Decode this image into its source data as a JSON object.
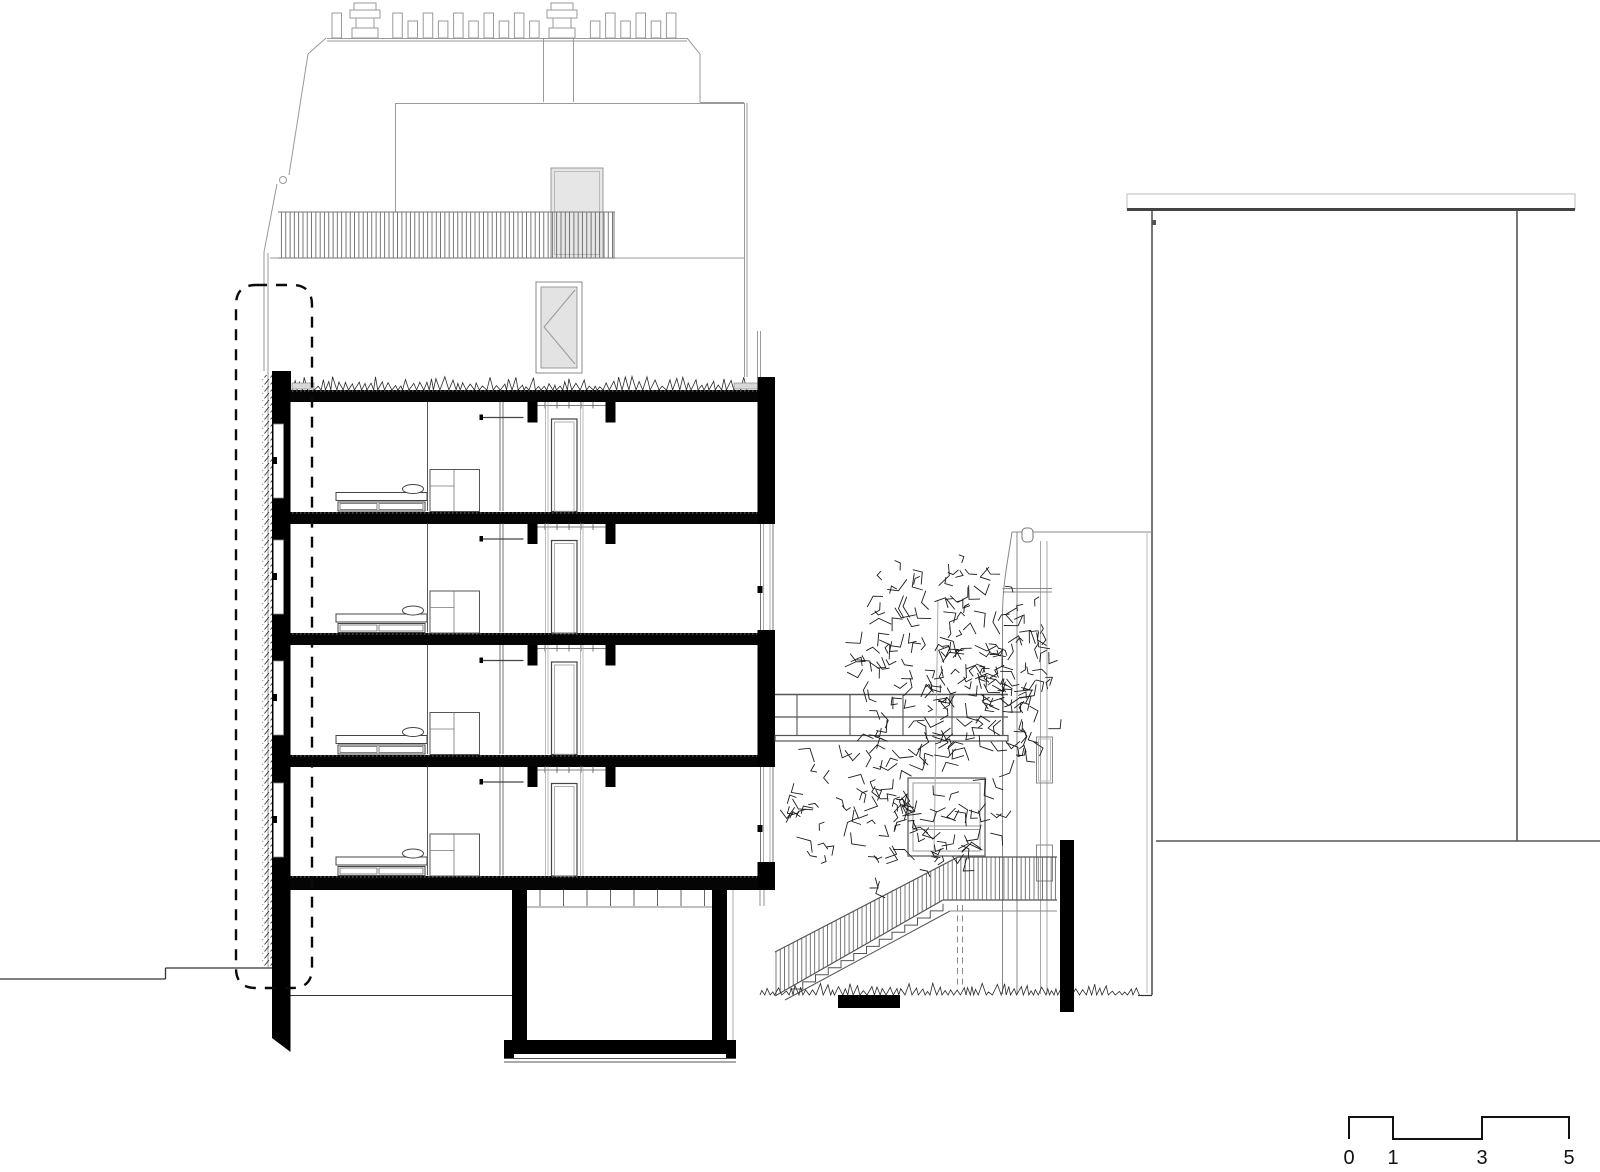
{
  "scale_bar": {
    "labels": [
      "0",
      "1",
      "3",
      "5"
    ]
  },
  "palette": {
    "background": "#ffffff",
    "section_poche": "#000000",
    "primary_line": "#333333",
    "secondary_line": "#777777",
    "light_line": "#9a9a9a",
    "glazing_fill": "#e6e6e6"
  }
}
